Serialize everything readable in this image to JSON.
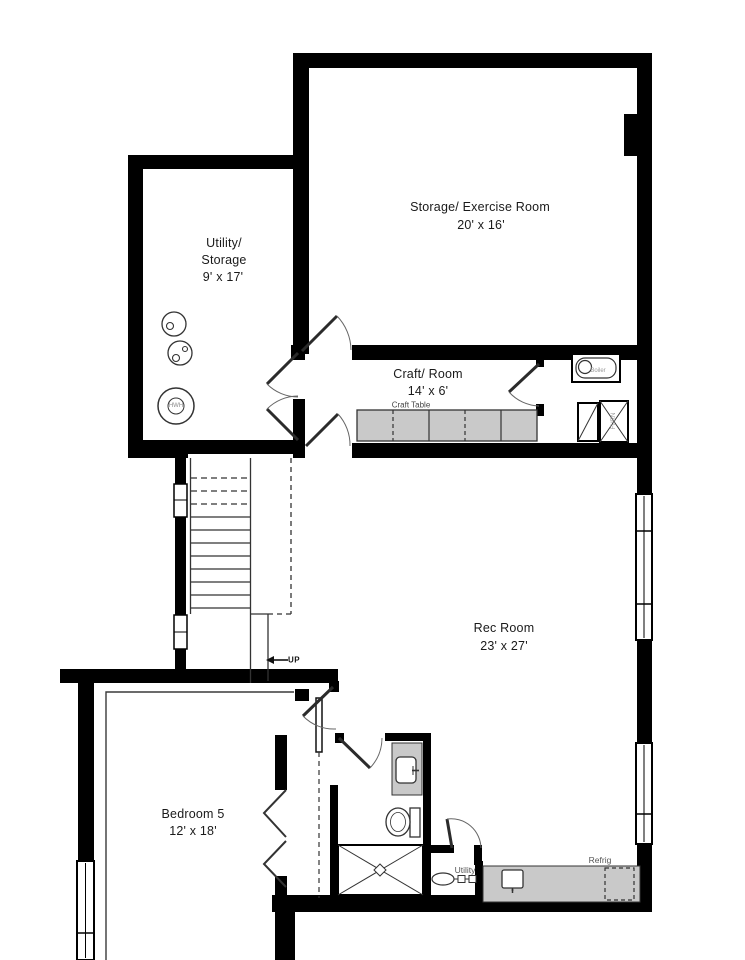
{
  "plan": {
    "rooms": [
      {
        "id": "storage_exercise",
        "name": "Storage/ Exercise Room",
        "dimensions": "20' x 16'"
      },
      {
        "id": "utility_storage",
        "name_lines": [
          "Utility/",
          "Storage"
        ],
        "dimensions": "9' x 17'"
      },
      {
        "id": "craft_room",
        "name": "Craft/ Room",
        "dimensions": "14' x 6'"
      },
      {
        "id": "rec_room",
        "name": "Rec Room",
        "dimensions": "23' x 27'"
      },
      {
        "id": "bedroom5",
        "name": "Bedroom 5",
        "dimensions": "12' x 18'"
      }
    ],
    "fixtures": {
      "craft_table": "Craft Table",
      "stairs_up": "UP",
      "utility_alcove": "Utility",
      "refrigerator": "Refrig",
      "boiler": "Boiler",
      "furnace": "FURN",
      "water_heater": "HWH"
    },
    "colors": {
      "wall": "#000000",
      "counter_fill": "#c9c9c9",
      "line": "#333333",
      "text": "#1a1a1a",
      "text_muted": "#555555",
      "text_faint": "#9a9a9a"
    }
  }
}
